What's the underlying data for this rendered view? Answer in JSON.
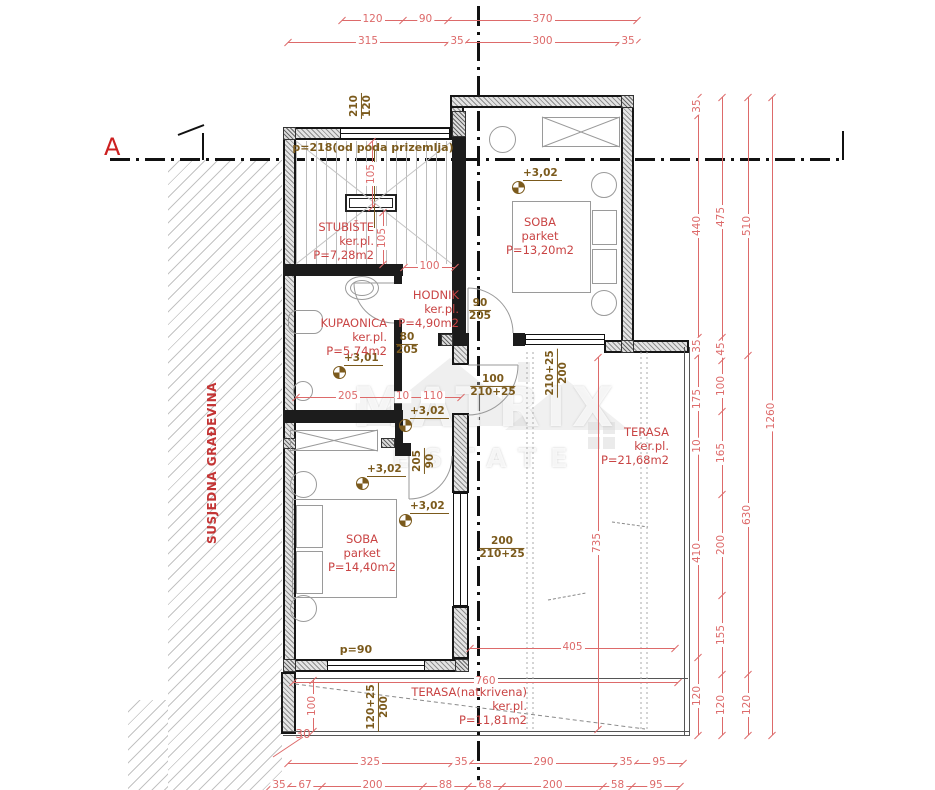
{
  "colors": {
    "dim": "#dd6a6a",
    "room_label": "#c94444",
    "brown": "#7b5a1c",
    "wall": "#1c1c1c",
    "accent_red": "#cc2020"
  },
  "watermark": {
    "top": "MATRIX",
    "bottom": "ESTATE"
  },
  "rooms": [
    {
      "id": "stubiste",
      "name": "STUBIŠTE",
      "floor": "ker.pl.",
      "area": "P=7,28m2",
      "x": 374,
      "y": 221,
      "align": "right"
    },
    {
      "id": "kupaonica",
      "name": "KUPAONICA",
      "floor": "ker.pl.",
      "area": "P=5,74m2",
      "x": 387,
      "y": 317,
      "align": "right"
    },
    {
      "id": "hodnik",
      "name": "HODNIK",
      "floor": "ker.pl.",
      "area": "P=4,90m2",
      "x": 459,
      "y": 289,
      "align": "right"
    },
    {
      "id": "soba-1",
      "name": "SOBA",
      "floor": "parket",
      "area": "P=13,20m2",
      "x": 540,
      "y": 216,
      "align": "center"
    },
    {
      "id": "soba-2",
      "name": "SOBA",
      "floor": "parket",
      "area": "P=14,40m2",
      "x": 362,
      "y": 533,
      "align": "center"
    },
    {
      "id": "terasa",
      "name": "TERASA",
      "floor": "ker.pl.",
      "area": "P=21,68m2",
      "x": 669,
      "y": 426,
      "align": "right"
    },
    {
      "id": "terasa-natkrivena",
      "name": "TERASA(natkrivena)",
      "floor": "ker.pl.",
      "area": "P=11,81m2",
      "x": 527,
      "y": 686,
      "align": "right"
    }
  ],
  "levels": [
    {
      "label": "+3,02",
      "x": 512,
      "y": 181
    },
    {
      "label": "+3,01",
      "x": 333,
      "y": 366
    },
    {
      "label": "+3,02",
      "x": 399,
      "y": 419
    },
    {
      "label": "+3,02",
      "x": 356,
      "y": 477
    },
    {
      "label": "+3,02",
      "x": 399,
      "y": 514
    }
  ],
  "door_marks": [
    {
      "top": "210",
      "bottom": "120",
      "x": 361,
      "y": 106,
      "rot": -90
    },
    {
      "top": "90",
      "bottom": "205",
      "x": 480,
      "y": 310,
      "rot": 0
    },
    {
      "top": "80",
      "bottom": "205",
      "x": 407,
      "y": 344,
      "rot": 0
    },
    {
      "top": "205",
      "bottom": "90",
      "x": 424,
      "y": 461,
      "rot": -90
    },
    {
      "top": "100",
      "bottom": "210+25",
      "x": 493,
      "y": 386,
      "rot": 0
    },
    {
      "top": "210+25",
      "bottom": "200",
      "x": 557,
      "y": 373,
      "rot": -90
    },
    {
      "top": "200",
      "bottom": "210+25",
      "x": 502,
      "y": 548,
      "rot": 0
    },
    {
      "top": "120+25",
      "bottom": "200",
      "x": 378,
      "y": 707,
      "rot": -90
    }
  ],
  "texts": [
    {
      "id": "note-floor-height",
      "label": "p=218(od poda prizemlja)",
      "x": 373,
      "y": 141,
      "color": "#7b5a1c",
      "size": 11,
      "align": "center",
      "bold": true
    },
    {
      "id": "note-parapet",
      "label": "p=90",
      "x": 356,
      "y": 643,
      "color": "#7b5a1c",
      "size": 11,
      "align": "center",
      "bold": true
    },
    {
      "id": "dim-offset-30",
      "label": "30",
      "x": 303,
      "y": 727,
      "color": "#dd6a6a",
      "size": 12,
      "align": "center",
      "bold": false
    },
    {
      "id": "section-marker-a",
      "label": "A",
      "x": 104,
      "y": 133,
      "color": "#cc2020",
      "size": 24,
      "align": "left",
      "bold": false
    },
    {
      "id": "neighbor-label",
      "label": "SUSJEDNA GRAĐEVINA",
      "x": 212,
      "y": 463,
      "color": "#c33535",
      "size": 12,
      "align": "center",
      "bold": true,
      "rot": -90,
      "ls": 0.5
    }
  ],
  "dimensions": {
    "chains": [
      {
        "dir": "h",
        "y": 20,
        "ticks": [
          342,
          403,
          448,
          637
        ],
        "labels": [
          "120",
          "90",
          "370"
        ]
      },
      {
        "dir": "h",
        "y": 42,
        "ticks": [
          288,
          448,
          466,
          619,
          637
        ],
        "labels": [
          "315",
          "35",
          "300",
          "35"
        ]
      },
      {
        "dir": "h",
        "y": 763,
        "ticks": [
          288,
          452,
          470,
          617,
          635,
          683
        ],
        "labels": [
          "325",
          "35",
          "290",
          "35",
          "95"
        ]
      },
      {
        "dir": "h",
        "y": 786,
        "ticks": [
          270,
          288,
          322,
          423,
          468,
          502,
          603,
          632,
          680
        ],
        "labels": [
          "35",
          "67",
          "200",
          "88",
          "68",
          "200",
          "58",
          "95"
        ]
      },
      {
        "dir": "h",
        "y": 397,
        "ticks": [
          296,
          400,
          405,
          461
        ],
        "labels": [
          "205",
          "10",
          "110"
        ]
      },
      {
        "dir": "h",
        "y": 267,
        "ticks": [
          404,
          455
        ],
        "labels": [
          "100"
        ]
      },
      {
        "dir": "h",
        "y": 682,
        "ticks": [
          293,
          678
        ],
        "labels": [
          "760"
        ]
      },
      {
        "dir": "h",
        "y": 648,
        "ticks": [
          470,
          675
        ],
        "labels": [
          "405"
        ]
      },
      {
        "dir": "v",
        "x": 698,
        "ticks": [
          97,
          115,
          337,
          355,
          443,
          449,
          657,
          735
        ],
        "labels": [
          "35",
          "440",
          "35",
          "175",
          "10",
          "410",
          "120"
        ]
      },
      {
        "dir": "v",
        "x": 722,
        "ticks": [
          97,
          337,
          360,
          411,
          494,
          595,
          674,
          735
        ],
        "labels": [
          "475",
          "45",
          "100",
          "165",
          "200",
          "155",
          "120"
        ]
      },
      {
        "dir": "v",
        "x": 748,
        "ticks": [
          97,
          355,
          674,
          735
        ],
        "labels": [
          "510",
          "630",
          "120"
        ]
      },
      {
        "dir": "v",
        "x": 772,
        "ticks": [
          97,
          735
        ],
        "labels": [
          "1260"
        ]
      },
      {
        "dir": "v",
        "x": 372,
        "ticks": [
          141,
          207
        ],
        "labels": [
          "105"
        ]
      },
      {
        "dir": "v",
        "x": 383,
        "ticks": [
          212,
          264
        ],
        "labels": [
          "105"
        ]
      },
      {
        "dir": "v",
        "x": 313,
        "ticks": [
          680,
          731
        ],
        "labels": [
          "100"
        ]
      },
      {
        "dir": "v",
        "x": 598,
        "ticks": [
          357,
          729
        ],
        "labels": [
          "735"
        ]
      }
    ]
  }
}
